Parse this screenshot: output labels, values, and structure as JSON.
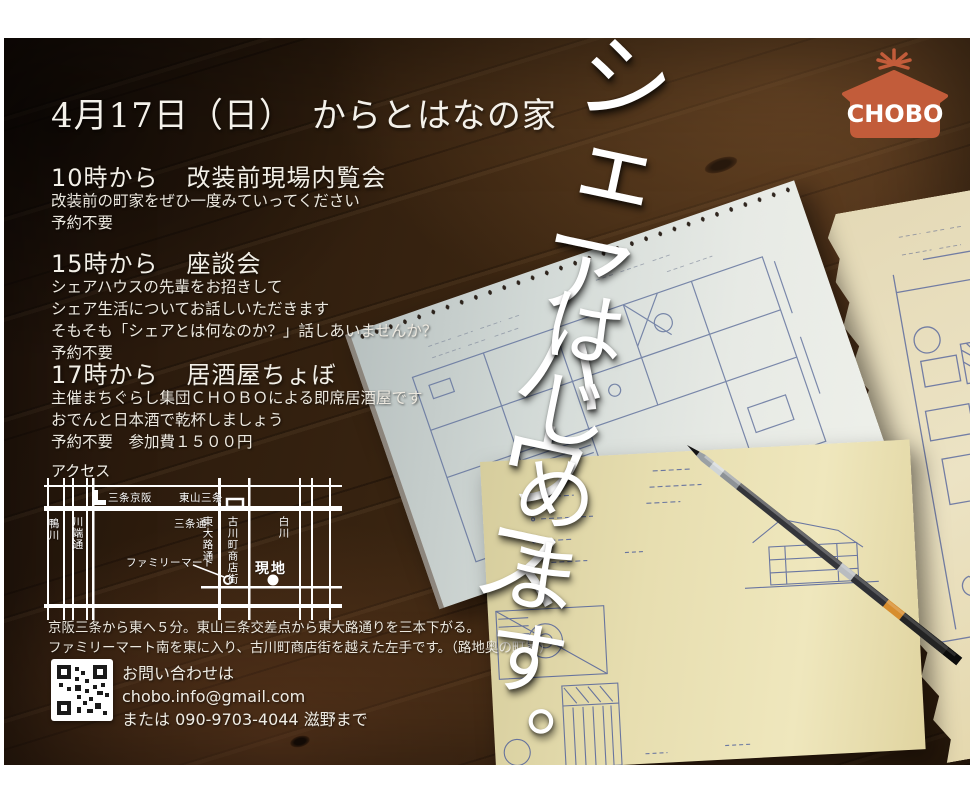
{
  "poster": {
    "date_title": "4月17日（日）　からとはなの家",
    "sections": [
      {
        "time": "10時から",
        "name": "改装前現場内覧会",
        "lines": [
          "改装前の町家をぜひ一度みていってください",
          "予約不要"
        ]
      },
      {
        "time": "15時から",
        "name": "座談会",
        "lines": [
          "シェアハウスの先輩をお招きして",
          "シェア生活についてお話しいただきます",
          "そもそも「シェアとは何なのか？」話しあいませんか？",
          "予約不要"
        ]
      },
      {
        "time": "17時から",
        "name": "居酒屋ちょぼ",
        "lines": [
          "主催まちぐらし集団ＣＨＯＢＯによる即席居酒屋です",
          "おでんと日本酒で乾杯しましょう",
          "予約不要　参加費１５００円"
        ]
      }
    ],
    "access": {
      "label": "アクセス",
      "map": {
        "station_left": "三条京阪",
        "station_right": "東山三条",
        "street_sanjo": "三条通",
        "river_kamo": "鴨川",
        "street_kawabata": "川端通",
        "street_higashioji": "東大路通",
        "street_furukawacho": "古川町商店街",
        "river_shirakawa": "白川",
        "poi_familymart": "ファミリーマート",
        "site_label": "現地"
      },
      "directions": [
        "京阪三条から東へ５分。東山三条交差点から東大路通りを三本下がる。",
        "ファミリーマート南を東に入り、古川町商店街を越えた左手です。（路地奥の町家）"
      ]
    },
    "contact": {
      "lines": [
        "お問い合わせは",
        "chobo.info@gmail.com",
        "または 090-9703-4044 滋野まで"
      ]
    },
    "logo_text": "CHOBO",
    "headline": {
      "col1": "シェアハウス",
      "col2": "はじめます。"
    },
    "colors": {
      "logo_orange": "#c25c3a",
      "ink_blue": "#46589a",
      "text_white": "#f2efe7",
      "wood_dark": "#2a1a0e"
    }
  }
}
